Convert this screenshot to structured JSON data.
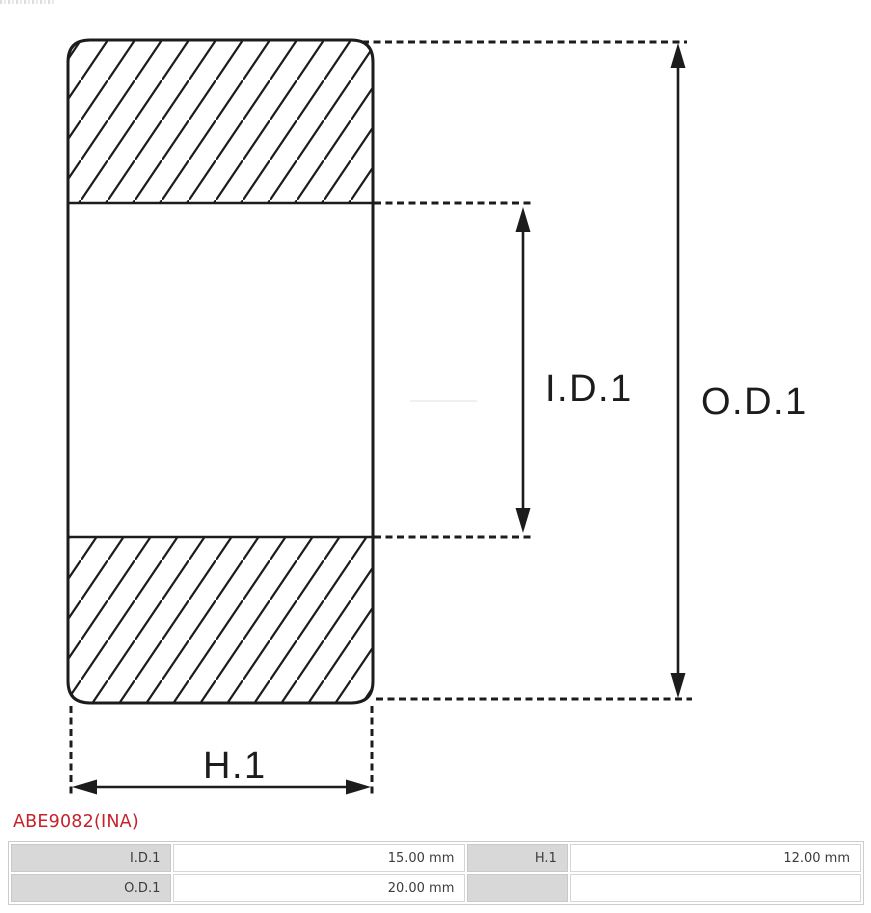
{
  "diagram": {
    "type": "bearing-cross-section",
    "line_color": "#1c1c1c",
    "labels": {
      "inner_diameter": "I.D.1",
      "outer_diameter": "O.D.1",
      "height": "H.1"
    }
  },
  "part_number": {
    "text": "ABE9082(INA)",
    "color": "#c4232b"
  },
  "spec_table": {
    "label_bg": "#d8d8d8",
    "rows": [
      [
        {
          "label": "I.D.1",
          "value": "15.00 mm"
        },
        {
          "label": "H.1",
          "value": "12.00 mm"
        }
      ],
      [
        {
          "label": "O.D.1",
          "value": "20.00 mm"
        },
        {
          "label": "",
          "value": ""
        }
      ]
    ]
  }
}
